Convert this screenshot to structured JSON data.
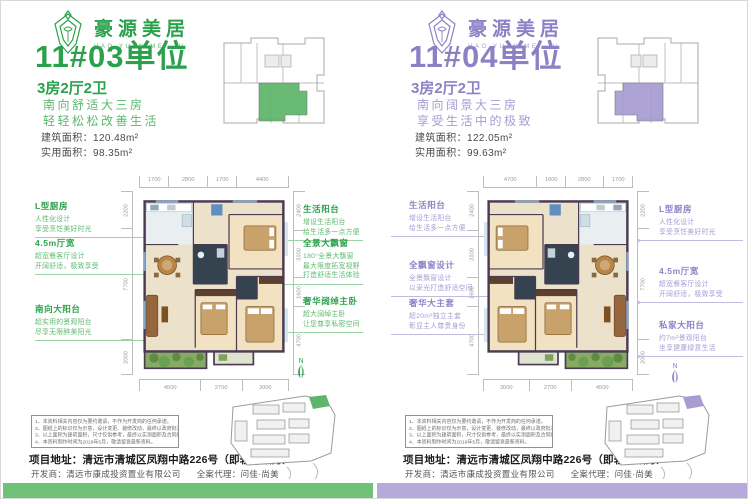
{
  "theme": {
    "green": "#2aa14b",
    "green_mid": "#5cb86e",
    "green_soft": "#9ad4a5",
    "green_hl": "#5cb56a",
    "green_bar": "#6fc277",
    "purple": "#8d81c6",
    "purple_mid": "#a79bd3",
    "purple_soft": "#c3bade",
    "purple_hl": "#a89cd2",
    "purple_bar": "#b6aadb"
  },
  "brand": {
    "name": "豪源美居",
    "sub": "HAO YUAN MEI JU"
  },
  "panels": [
    {
      "unit_title": "11#03单位",
      "unit_layout": "3房2厅2卫",
      "tagline_line1": "南向舒适大三房",
      "tagline_line2": "轻轻松松改善生活",
      "area_built": "建筑面积：120.48m²",
      "area_usable": "实用面积：98.35m²",
      "compass": "N",
      "dims_top": [
        "1700",
        "2800",
        "1700",
        "4400"
      ],
      "dims_bottom": [
        "4500",
        "2700",
        "3000"
      ],
      "dims_outer": [
        "2200",
        "7700",
        "2000"
      ],
      "dims_inner": [
        "2400",
        "3100",
        "1600",
        "4700"
      ],
      "annotations_outer": [
        {
          "title": "L型厨房",
          "lines": [
            "人性化设计",
            "享受烹饪美好时光"
          ]
        },
        {
          "title": "4.5m厅宽",
          "lines": [
            "超宽餐客厅设计",
            "开阔舒适，极致享受"
          ]
        },
        {
          "title": "南向大阳台",
          "lines": [
            "超实用的景观阳台",
            "尽享无限醉美阳光"
          ]
        }
      ],
      "annotations_inner": [
        {
          "title": "生活阳台",
          "lines": [
            "增设生活阳台",
            "给生活多一点方便"
          ]
        },
        {
          "title": "全景大飘窗",
          "lines": [
            "180°全景大飘窗",
            "最大限度拓宽视野",
            "打造舒适生活体验"
          ]
        },
        {
          "title": "奢华阔绰主卧",
          "lines": [
            "超大阔绰主卧",
            "让您尊享私密空间"
          ]
        }
      ]
    },
    {
      "unit_title": "11#04单位",
      "unit_layout": "3房2厅2卫",
      "tagline_line1": "南向阔景大三房",
      "tagline_line2": "享受生活中的极致",
      "area_built": "建筑面积：122.05m²",
      "area_usable": "实用面积：99.63m²",
      "compass": "N",
      "dims_top": [
        "4700",
        "1600",
        "2800",
        "1700"
      ],
      "dims_bottom": [
        "3000",
        "2700",
        "4500"
      ],
      "dims_outer": [
        "2200",
        "7700",
        "2000"
      ],
      "dims_inner": [
        "2400",
        "3100",
        "1600",
        "4700"
      ],
      "annotations_inner": [
        {
          "title": "生活阳台",
          "lines": [
            "增设生活阳台",
            "给生活多一点方便"
          ]
        },
        {
          "title": "全飘窗设计",
          "lines": [
            "全景飘窗设计",
            "以采光打造舒适空间"
          ]
        },
        {
          "title": "奢华大主套",
          "lines": [
            "超20m²独立主套",
            "彰显主人尊贵身份"
          ]
        }
      ],
      "annotations_outer": [
        {
          "title": "L型厨房",
          "lines": [
            "人性化设计",
            "享受烹饪美好时光"
          ]
        },
        {
          "title": "4.5m厅宽",
          "lines": [
            "超宽餐客厅设计",
            "开阔舒适，极致享受"
          ]
        },
        {
          "title": "私家大阳台",
          "lines": [
            "约7m²景观阳台",
            "坐享健康绿意生活"
          ]
        }
      ]
    }
  ],
  "footer": {
    "disclaimer": [
      "1、本资料相关内容仅为要约邀请，不作为开发商的任何承诺。",
      "2、图纸上的标识仅为示意，设计变更、装修改动，最终以政府批准图纸为准。",
      "3、以上面积为建筑面积，尺寸仅供参考，最终以实测面积及合同约定为准。",
      "4、本资料制作时间为2019年5月，敬请留意最新资料。"
    ],
    "address": "项目地址：清远市清城区凤翔中路226号（即轻轨站旁）",
    "developer": "开发商：清远市康成投资置业有限公司",
    "agent": "全案代理：问佳·尚美"
  }
}
